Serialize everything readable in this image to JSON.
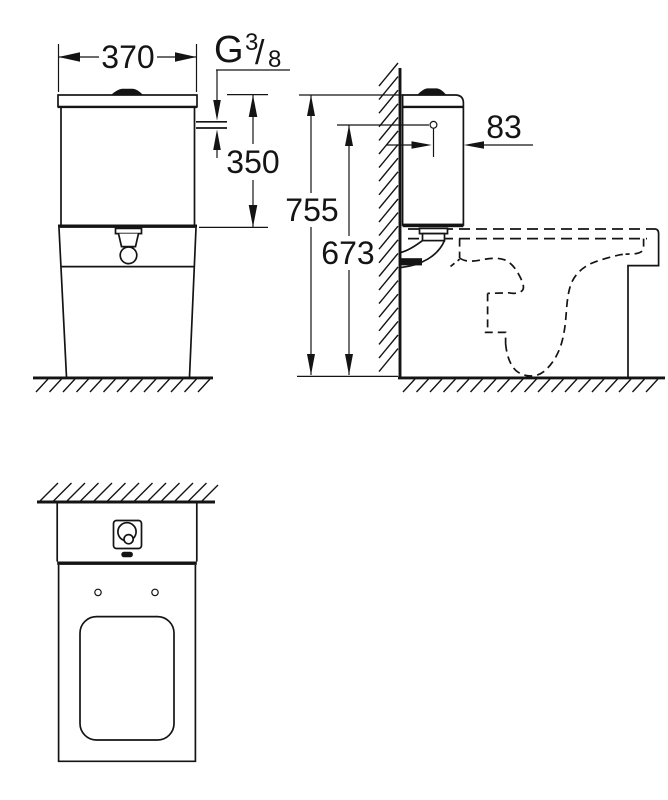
{
  "colors": {
    "ink": "#141414",
    "background": "#ffffff"
  },
  "dims": {
    "width": "370",
    "cistern_height": "350",
    "total_height": "755",
    "inlet_height": "673",
    "inlet_offset": "83"
  },
  "thread": {
    "letter": "G",
    "numerator": "3",
    "slash": "/",
    "denominator": "8"
  }
}
